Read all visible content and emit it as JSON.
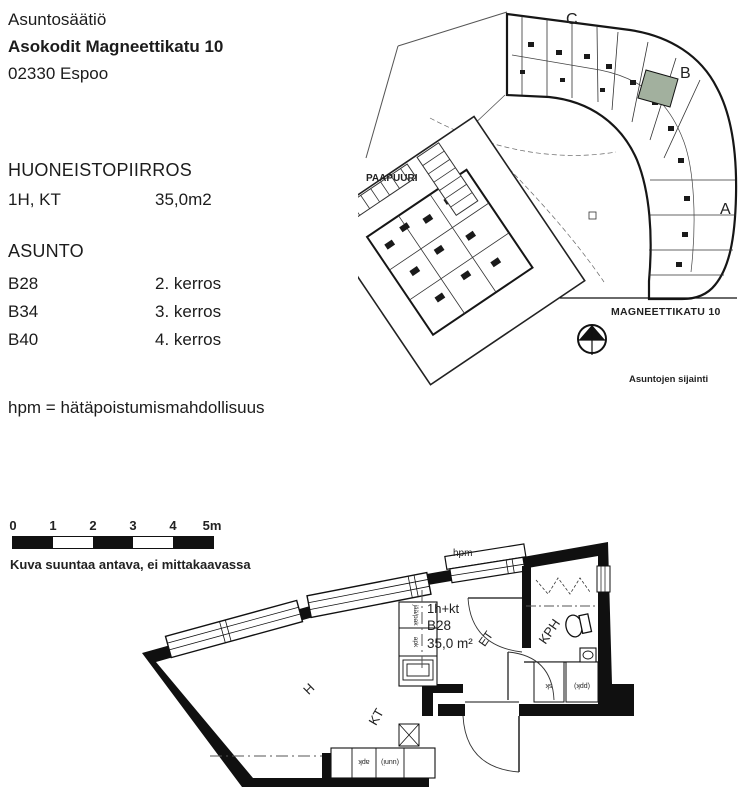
{
  "header": {
    "organization": "Asuntosäätiö",
    "title": "Asokodit Magneettikatu 10",
    "address": "02330 Espoo"
  },
  "info": {
    "drawing_title": "HUONEISTOPIIRROS",
    "unit_layout": "1H, KT",
    "unit_area": "35,0m2",
    "apartments_title": "ASUNTO",
    "apartments": [
      {
        "id": "B28",
        "floor": "2. kerros"
      },
      {
        "id": "B34",
        "floor": "3. kerros"
      },
      {
        "id": "B40",
        "floor": "4. kerros"
      }
    ]
  },
  "note": "hpm = hätäpoistumismahdollisuus",
  "site_plan": {
    "wing_labels": {
      "c": "C",
      "b": "B",
      "a": "A"
    },
    "street_label": "MAGNEETTIKATU 10",
    "caption": "Asuntojen sijainti",
    "adjacent_building": "PAAPUURI",
    "highlight_color": "#a2b09e",
    "compass": "north-arrow"
  },
  "scale_bar": {
    "ticks": [
      "0",
      "1",
      "2",
      "3",
      "4",
      "5m"
    ],
    "caption": "Kuva suuntaa antava, ei mittakaavassa"
  },
  "floor_plan": {
    "window_label": "hpm",
    "unit_type": "1h+kt",
    "unit_id": "B28",
    "unit_area": "35,0 m²",
    "rooms": {
      "living": "H",
      "kitchen": "KT",
      "hall": "ET",
      "bathroom": "KPH"
    },
    "fixtures": {
      "closet": "sk",
      "washer": "(ppk)",
      "fridge": "jää/pak",
      "dishwasher": "apk",
      "counter_left": "apk",
      "oven": "(uuni)"
    }
  }
}
